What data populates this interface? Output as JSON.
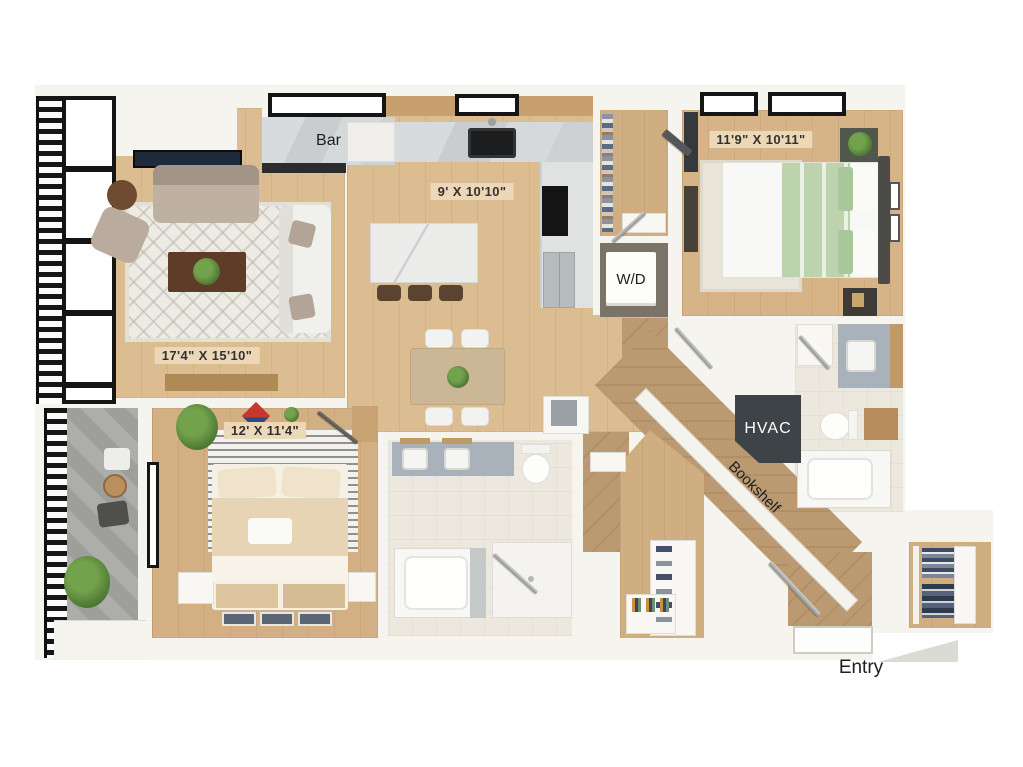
{
  "labels": {
    "bar": "Bar",
    "kitchen_dim": "9' X 10'10\"",
    "bedroom1_dim": "11'9\" X 10'11\"",
    "washer_dryer": "W/D",
    "living_dim": "17'4\" X 15'10\"",
    "bedroom2_dim": "12' X 11'4\"",
    "hvac": "HVAC",
    "bookshelf": "Bookshelf",
    "entry": "Entry"
  },
  "colors": {
    "background": "#ffffff",
    "wall": "#f6f4ee",
    "wood_light": "#dcbd92",
    "wood_medium": "#cfae82",
    "wood_dark": "#bb9a72",
    "tile": "#ece8dd",
    "balcony_concrete": "#a6a6a2",
    "label_chip": "#ecd9ba",
    "hvac_box": "#3e4347",
    "bedding_green": "#bcd3ae",
    "bedding_tan": "#e6d4b5",
    "window_frame": "#151515"
  }
}
